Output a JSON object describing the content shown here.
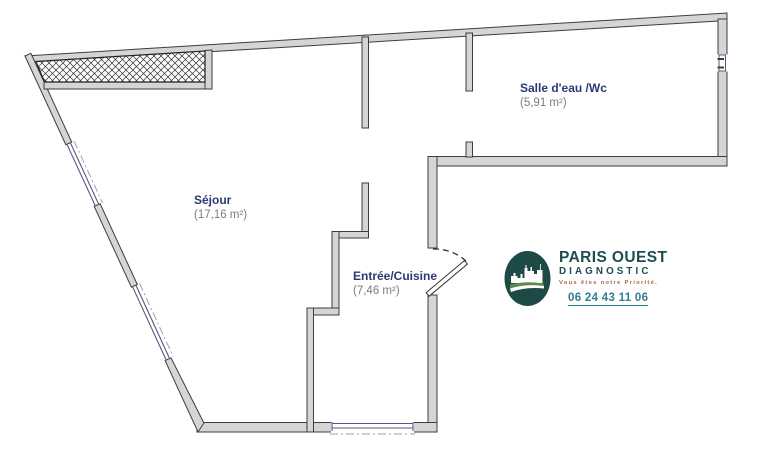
{
  "plan": {
    "kind": "apartment floor plan",
    "background": "#ffffff"
  },
  "rooms": [
    {
      "id": "sejour",
      "name": "Séjour",
      "area": "(17,16 m²)"
    },
    {
      "id": "salle-deau-wc",
      "name": "Salle d'eau /Wc",
      "area": "(5,91 m²)"
    },
    {
      "id": "entree-cuisine",
      "name": "Entrée/Cuisine",
      "area": "(7,46 m²)"
    }
  ],
  "logo": {
    "line1": "PARIS OUEST",
    "line2": "DIAGNOSTIC",
    "tagline": "Vous êtes notre Priorité.",
    "phone": "06 24 43 11 06",
    "emblem_icon": "city-skyline-icon"
  },
  "colors": {
    "wall_fill": "#d5d5d5",
    "wall_stroke": "#3d3d3d",
    "room_name_text": "#2b3a74",
    "room_area_text": "#7d7d7d",
    "window_line": "#555a80",
    "dashdot_line": "#9aa2b8",
    "brand_teal": "#1d4d4f",
    "phone_teal": "#2f7f93",
    "tagline_red": "#b5604c",
    "emblem_teal": "#1d4a47",
    "emblem_green": "#5c8c45"
  }
}
